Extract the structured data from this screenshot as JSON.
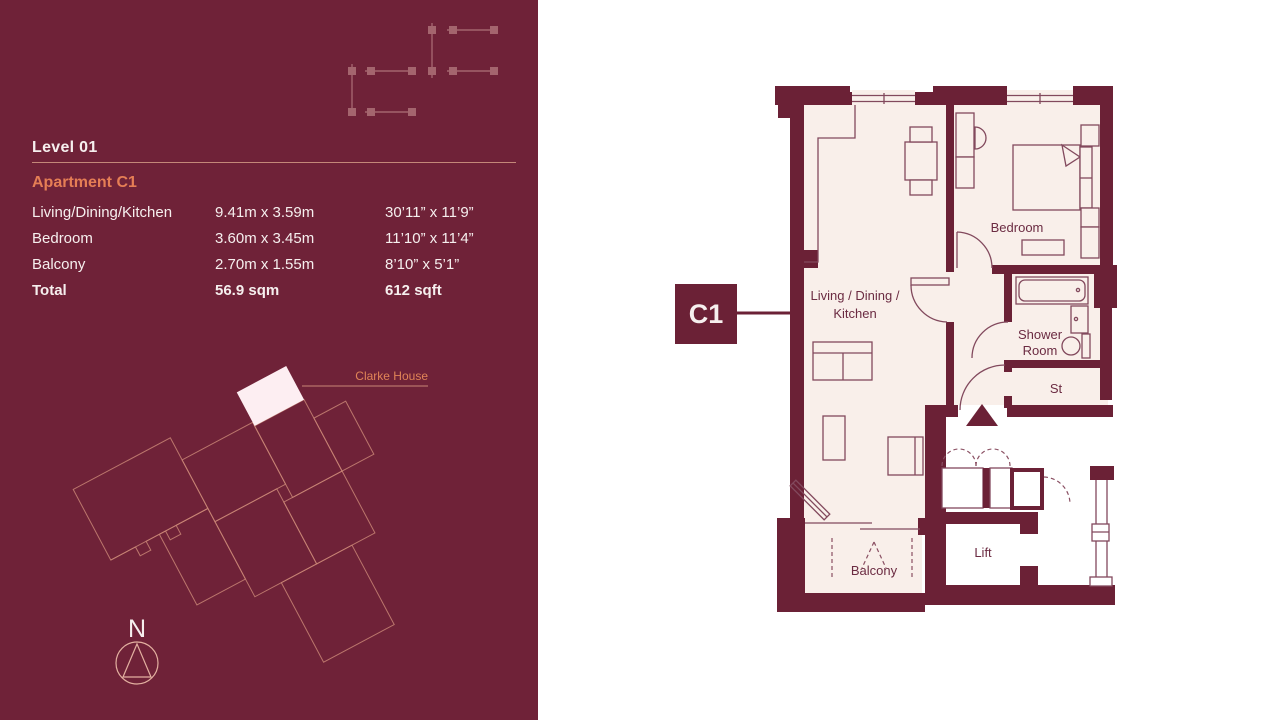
{
  "panel": {
    "level_title": "Level 01",
    "apartment_title": "Apartment C1",
    "dimensions": {
      "rows": [
        {
          "room": "Living/Dining/Kitchen",
          "metric": "9.41m x 3.59m",
          "imperial": "30’11” x 11’9”"
        },
        {
          "room": "Bedroom",
          "metric": "3.60m x 3.45m",
          "imperial": "11’10” x 11’4”"
        },
        {
          "room": "Balcony",
          "metric": "2.70m x 1.55m",
          "imperial": "8’10” x 5’1”"
        },
        {
          "room": "Total",
          "metric": "56.9 sqm",
          "imperial": "612 sqft"
        }
      ]
    },
    "site_plan": {
      "callout": "Clarke House",
      "compass": "N"
    }
  },
  "floorplan": {
    "marker": "C1",
    "rooms": {
      "living_line1": "Living / Dining /",
      "living_line2": "Kitchen",
      "bedroom": "Bedroom",
      "shower_line1": "Shower",
      "shower_line2": "Room",
      "storage": "St",
      "balcony": "Balcony",
      "lift": "Lift"
    }
  },
  "colors": {
    "panel_background": "#6f2238",
    "wall": "#6b2136",
    "floor_fill": "#f9efea",
    "accent_orange": "#e57e55",
    "salmon_outline": "#c98576",
    "light_text": "#f6efee",
    "plan_text": "#6b2b42"
  }
}
